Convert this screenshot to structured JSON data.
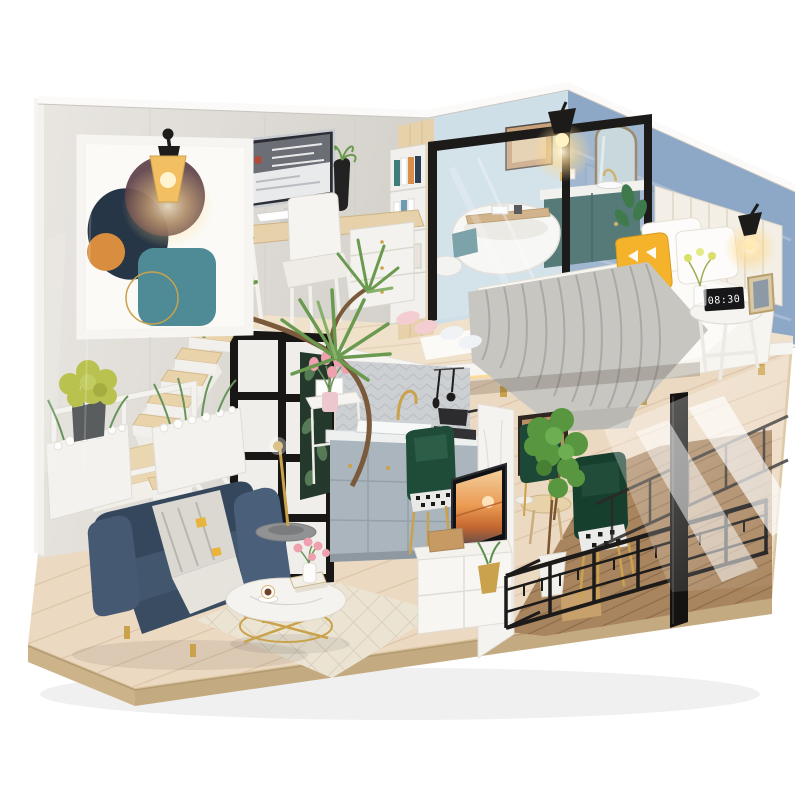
{
  "scene": {
    "subject": "DIY miniature dollhouse kit - two-storey loft apartment diorama",
    "setting": "studio product photo on seamless white background",
    "enclosure": "clear acrylic dust cover over a plywood display base",
    "lighting": "warm LED wall lamps lit inside the model"
  },
  "clock": {
    "display": "08:30"
  },
  "palette": {
    "background": "#ffffff",
    "base_wood": "#d8c29a",
    "base_edge": "#c4aa80",
    "floor_wood": "#ecd9c2",
    "loft_wood": "#f0e1ca",
    "balcony_wood": "#a9855f",
    "rug_cream": "#ece4d2",
    "wall_concrete": "#e9e6e1",
    "wall_bath_blue": "#cfdfe8",
    "wall_blue": "#8da7c6",
    "wall_wood": "#e6d1ab",
    "fascia_white": "#f7f5f1",
    "marble_white": "#f5f3ef",
    "sofa_navy": "#42566e",
    "blanket_gray": "#c7c6c1",
    "pillow_yellow": "#f5b32b",
    "headboard_ivory": "#f3efe6",
    "vanity_teal": "#2c5a55",
    "chair_green": "#1f4c39",
    "gold": "#c9a24b",
    "black_metal": "#1c1b1a",
    "plant_green": "#6a9a4f",
    "fern_green": "#67945a",
    "glow_warm": "#ffd98c",
    "tulip_pink": "#efa0ae",
    "white_paint": "#f4f2ee"
  },
  "upper_floor": {
    "study": {
      "items": [
        "desk",
        "computer-monitor",
        "keyboard",
        "white-chair",
        "drawer-unit",
        "bookshelf",
        "black-vase-plant",
        "globe-lamp"
      ]
    },
    "bathroom": {
      "items": [
        "freestanding-bathtub",
        "bath-caddy-tray",
        "teal-vanity",
        "gold-faucet",
        "arch-mirror",
        "wall-art",
        "glass-partition",
        "towel",
        "plant"
      ]
    },
    "bedroom": {
      "items": [
        "upholstered-headboard",
        "double-bed",
        "gray-knit-blanket",
        "white-pillows",
        "yellow-triangle-pillow",
        "bedside-table",
        "digital-clock",
        "photo-frame",
        "wall-lamps",
        "slippers"
      ]
    }
  },
  "lower_floor": {
    "living_room": {
      "items": [
        "navy-sofa",
        "throw-blanket",
        "round-coffee-table",
        "coffee-cup",
        "books",
        "tulip-vase",
        "diamond-rug",
        "floor-lamp",
        "abstract-wall-art",
        "wall-lamp",
        "yucca-plant"
      ]
    },
    "kitchen": {
      "items": [
        "gray-cabinets",
        "marble-counter",
        "sink",
        "gold-faucet",
        "herringbone-backsplash",
        "hanging-utensils",
        "stove-pot",
        "console-table",
        "tulip-bouquet",
        "picture-frames"
      ]
    },
    "tv_area": {
      "items": [
        "marble-media-wall",
        "flatscreen-tv-sunset",
        "tv-console",
        "tissue-box",
        "gold-planter",
        "wood-crate"
      ]
    },
    "dining": {
      "items": [
        "green-velvet-chairs",
        "houndstooth-cushions",
        "wood-table",
        "potted-tree",
        "sideboard-niche"
      ]
    },
    "balcony": {
      "items": [
        "black-metal-railing",
        "wood-deck",
        "corner-post"
      ]
    },
    "stairs": {
      "items": [
        "white-staircase",
        "wood-treads",
        "landing",
        "white-railing",
        "pebble-planters",
        "ferns",
        "glass-door"
      ]
    }
  }
}
